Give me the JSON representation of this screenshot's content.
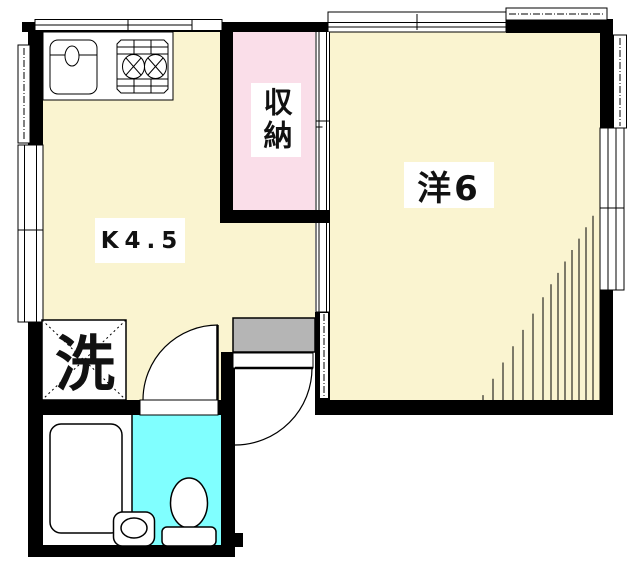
{
  "plan": {
    "title": "1K apartment floor plan",
    "rooms": {
      "kitchen": {
        "label": "K4.5"
      },
      "western_room": {
        "label": "洋6"
      },
      "storage": {
        "label": "収納"
      },
      "laundry": {
        "label": "洗"
      }
    },
    "colors": {
      "floor_yellow": "#FAF4D0",
      "storage_pink": "#FADEE9",
      "toilet_cyan": "#80FFFF",
      "entrance_gray": "#B5B5B5",
      "wall_black": "#000000",
      "line_black": "#000000",
      "fixture_white": "#FFFFFF"
    }
  }
}
